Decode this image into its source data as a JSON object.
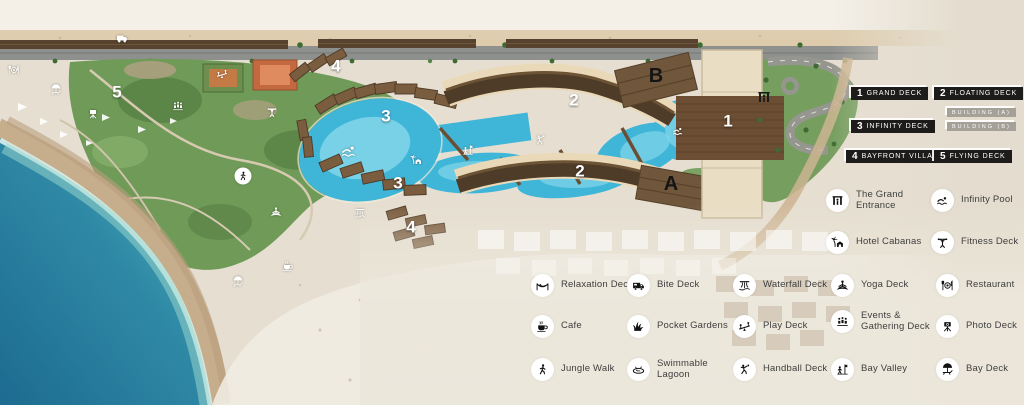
{
  "deck_legend": {
    "items": [
      {
        "num": "1",
        "label": "GRAND DECK"
      },
      {
        "num": "2",
        "label": "FLOATING DECK"
      },
      {
        "num": "3",
        "label": "INFINITY DECK"
      },
      {
        "num": "4",
        "label": "BAYFRONT VILLAS"
      },
      {
        "num": "5",
        "label": "FLYING DECK"
      }
    ],
    "buildings": [
      {
        "label": "BUILDING (A)"
      },
      {
        "label": "BUILDING (B)"
      }
    ]
  },
  "amenities": [
    {
      "icon": "entrance",
      "label": "The Grand Entrance"
    },
    {
      "icon": "swimmer",
      "label": "Infinity Pool"
    },
    {
      "icon": "cabana",
      "label": "Hotel Cabanas"
    },
    {
      "icon": "fitness",
      "label": "Fitness Deck"
    },
    {
      "icon": "hammock",
      "label": "Relaxation Deck"
    },
    {
      "icon": "foodtruck",
      "label": "Bite Deck"
    },
    {
      "icon": "waterfall",
      "label": "Waterfall Deck"
    },
    {
      "icon": "yoga",
      "label": "Yoga Deck"
    },
    {
      "icon": "restaurant",
      "label": "Restaurant"
    },
    {
      "icon": "cafe",
      "label": "Cafe"
    },
    {
      "icon": "garden",
      "label": "Pocket Gardens"
    },
    {
      "icon": "play",
      "label": "Play Deck"
    },
    {
      "icon": "events",
      "label": "Events & Gathering Deck"
    },
    {
      "icon": "photo",
      "label": "Photo Deck"
    },
    {
      "icon": "walk",
      "label": "Jungle Walk"
    },
    {
      "icon": "lagoon",
      "label": "Swimmable Lagoon"
    },
    {
      "icon": "handball",
      "label": "Handball Deck"
    },
    {
      "icon": "bayvalley",
      "label": "Bay Valley"
    },
    {
      "icon": "baydeck",
      "label": "Bay Deck"
    }
  ],
  "map_markers": [
    {
      "label": "5"
    },
    {
      "label": "4"
    },
    {
      "label": "3"
    },
    {
      "label": "3"
    },
    {
      "label": "4"
    },
    {
      "label": "2"
    },
    {
      "label": "2"
    },
    {
      "label": "1"
    },
    {
      "label": "B"
    },
    {
      "label": "A"
    }
  ],
  "colors": {
    "ocean_deep": "#1d6b90",
    "ocean_shallow": "#8fd6cf",
    "lagoon": "#3fb5d8",
    "sand": "#e6dfd1",
    "beach": "#f4f0e8",
    "roof_dark": "#4e3b28",
    "villa_roof": "#7a5c3e",
    "green": "#6f9a58",
    "legend_box": "#1d1c1a",
    "building_tag": "#a5a098"
  }
}
